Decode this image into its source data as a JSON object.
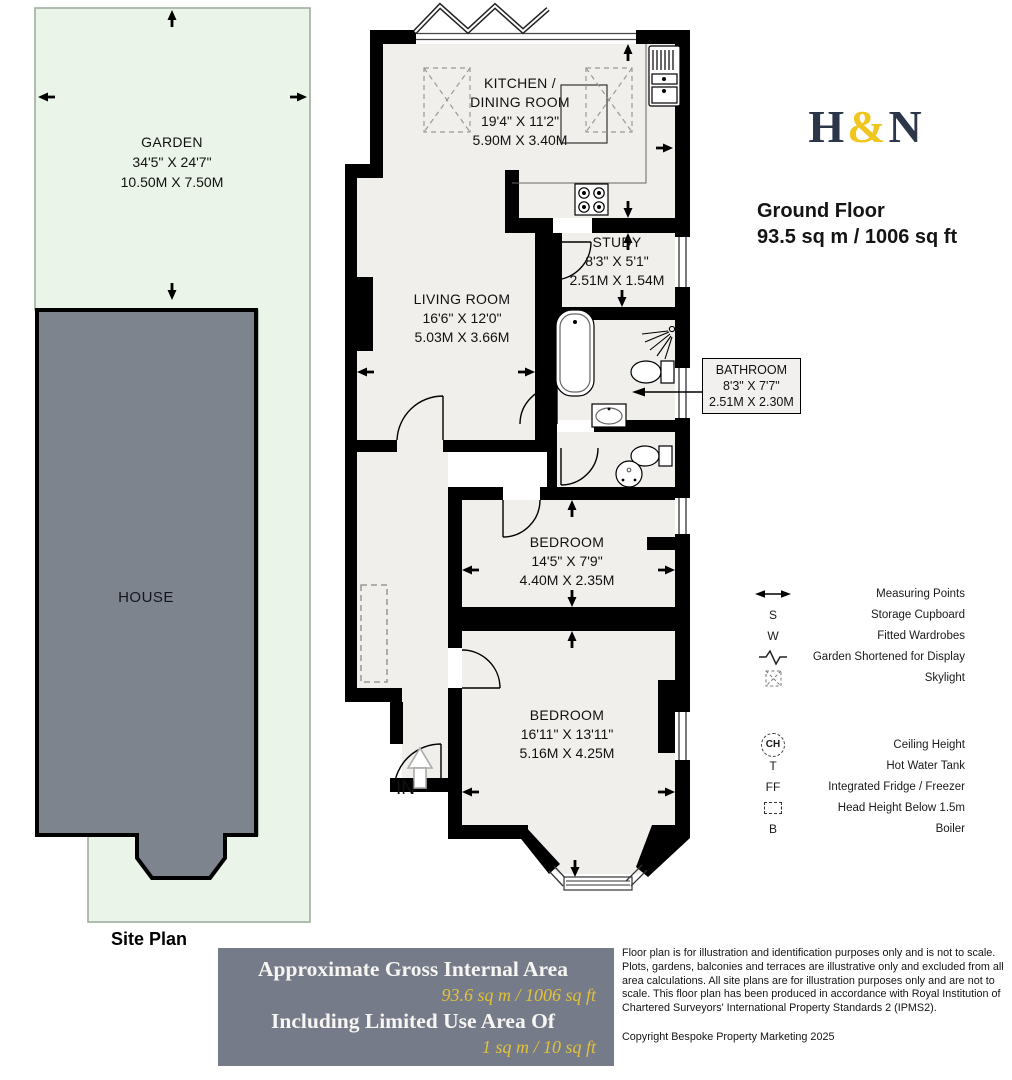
{
  "header": {
    "logo_h": "H",
    "logo_amp": "&",
    "logo_n": "N",
    "floor_title": "Ground Floor",
    "floor_area": "93.5 sq m / 1006 sq ft"
  },
  "site_plan": {
    "caption": "Site Plan",
    "garden": {
      "name": "GARDEN",
      "imperial": "34'5\" X 24'7\"",
      "metric": "10.50M X 7.50M"
    },
    "house_label": "HOUSE"
  },
  "floor_plan": {
    "entrance_label": "IN",
    "rooms": {
      "kitchen": {
        "name1": "KITCHEN /",
        "name2": "DINING ROOM",
        "imperial": "19'4\" X 11'2\"",
        "metric": "5.90M X 3.40M"
      },
      "living": {
        "name": "LIVING ROOM",
        "imperial": "16'6\" X 12'0\"",
        "metric": "5.03M X 3.66M"
      },
      "study": {
        "name": "STUDY",
        "imperial": "8'3\" X 5'1\"",
        "metric": "2.51M X 1.54M"
      },
      "bathroom": {
        "name": "BATHROOM",
        "imperial": "8'3\" X 7'7\"",
        "metric": "2.51M X 2.30M"
      },
      "bedroom1": {
        "name": "BEDROOM",
        "imperial": "14'5\" X 7'9\"",
        "metric": "4.40M X 2.35M"
      },
      "bedroom2": {
        "name": "BEDROOM",
        "imperial": "16'11\" X 13'11\"",
        "metric": "5.16M X 4.25M"
      }
    }
  },
  "legend": {
    "group1": [
      {
        "symbol": "measuring-arrows",
        "label": "Measuring Points"
      },
      {
        "symbol": "S",
        "label": "Storage Cupboard"
      },
      {
        "symbol": "W",
        "label": "Fitted Wardrobes"
      },
      {
        "symbol": "zigzag",
        "label": "Garden Shortened for Display"
      },
      {
        "symbol": "skylight",
        "label": "Skylight"
      }
    ],
    "group2": [
      {
        "symbol": "CH",
        "label": "Ceiling Height"
      },
      {
        "symbol": "T",
        "label": "Hot Water Tank"
      },
      {
        "symbol": "FF",
        "label": "Integrated Fridge / Freezer"
      },
      {
        "symbol": "head-height",
        "label": "Head Height Below 1.5m"
      },
      {
        "symbol": "B",
        "label": "Boiler"
      }
    ]
  },
  "footer": {
    "gross_title": "Approximate Gross Internal Area",
    "gross_value": "93.6 sq m / 1006 sq ft",
    "limited_title": "Including Limited Use Area Of",
    "limited_value": "1 sq m / 10 sq ft"
  },
  "disclaimer": {
    "text": "Floor plan is for illustration and identification purposes only and is not to scale. Plots, gardens, balconies and terraces are illustrative only and excluded from all area calculations.  All site plans are for illustration purposes only and are not to scale. This floor plan has been produced in accordance with Royal Institution of Chartered Surveyors' International Property Standards 2 (IPMS2).",
    "copyright": "Copyright Bespoke Property Marketing 2025"
  },
  "colors": {
    "wall_black": "#000000",
    "floor_fill": "#f0efeb",
    "garden_green": "#ebf4e9",
    "house_grey": "#7d848e",
    "footer_bg": "#757b88",
    "footer_gold": "#e2c23b",
    "logo_navy": "#2b3648",
    "logo_gold": "#efc51f"
  }
}
